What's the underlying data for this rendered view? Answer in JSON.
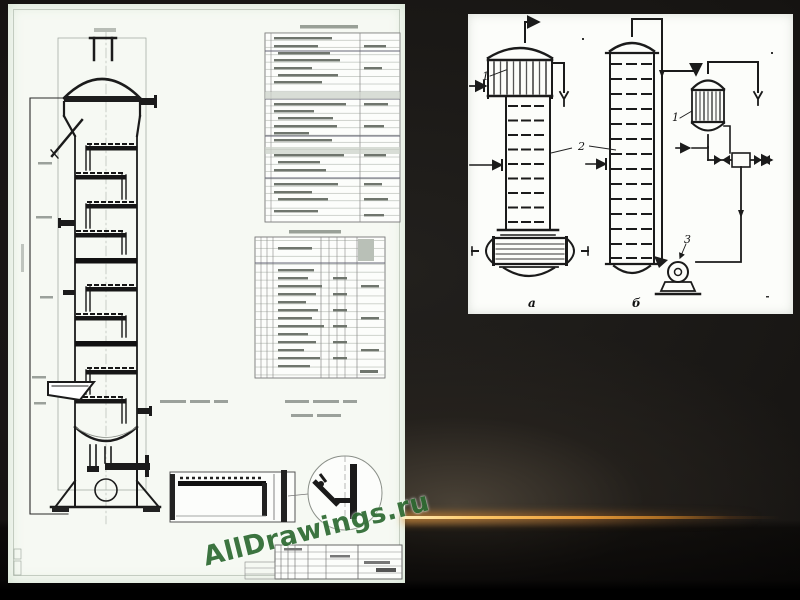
{
  "slide": {
    "watermark": {
      "text": "AllDrawings.ru",
      "color": "#2f6b33"
    },
    "accent_line_color": "#f0a83c"
  },
  "right_diagram": {
    "labels": {
      "exchanger_a": "1",
      "column": "2",
      "exchanger_b": "1",
      "pump": "3",
      "variant_a": "а",
      "variant_b": "б"
    }
  }
}
